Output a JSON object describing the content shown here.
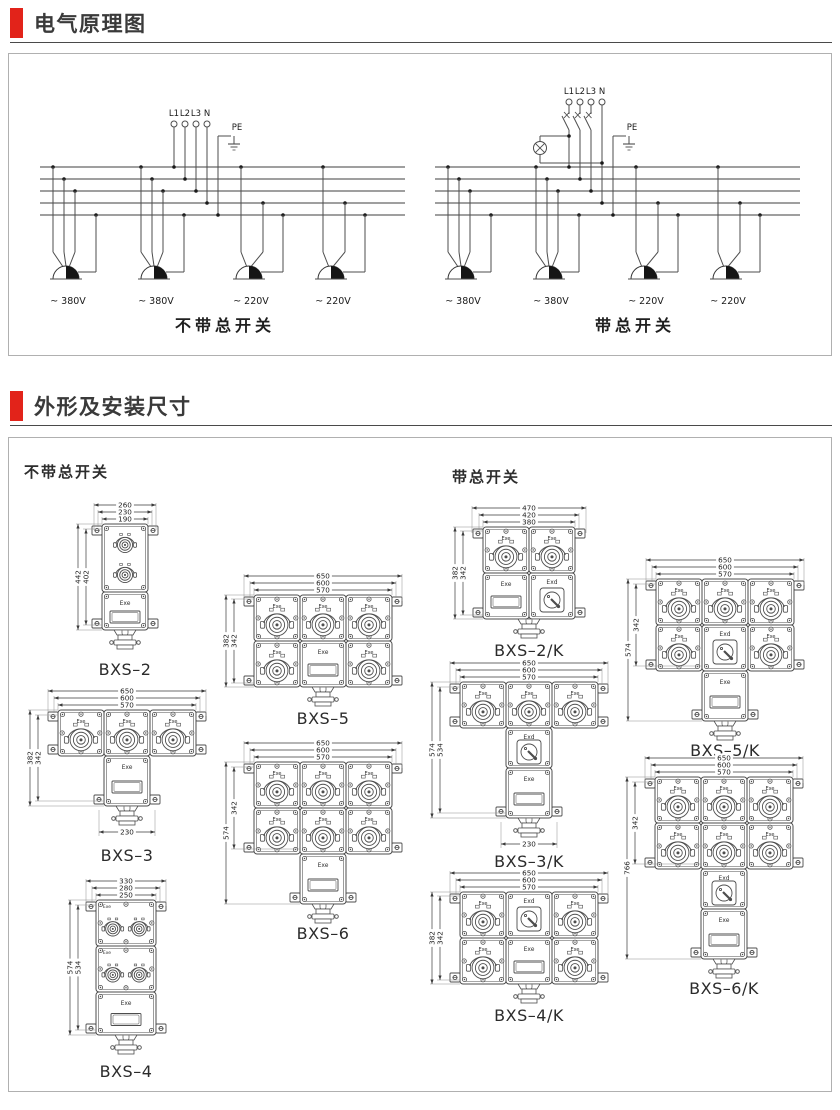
{
  "page": {
    "accent_color": "#e2231a",
    "section1_title": "电气原理图",
    "section2_title": "外形及安装尺寸"
  },
  "schematic": {
    "phase_labels": [
      "L1",
      "L2",
      "L3",
      "N"
    ],
    "pe_label": "PE",
    "diagrams": [
      {
        "caption": "不带总开关",
        "has_main_switch": false,
        "outlets": [
          {
            "voltage": "~ 380V"
          },
          {
            "voltage": "~ 380V"
          },
          {
            "voltage": "~ 220V"
          },
          {
            "voltage": "~ 220V"
          }
        ]
      },
      {
        "caption": "带总开关",
        "has_main_switch": true,
        "outlets": [
          {
            "voltage": "~ 380V"
          },
          {
            "voltage": "~ 380V"
          },
          {
            "voltage": "~ 220V"
          },
          {
            "voltage": "~ 220V"
          }
        ]
      }
    ]
  },
  "dimensions": {
    "left_group_label": "不带总开关",
    "right_group_label": "带总开关",
    "socket_label": "Exe",
    "switch_label": "Exd",
    "window_label": "Exe",
    "products": [
      {
        "id": "bxs2",
        "caption": "BXS–2",
        "top_dims": [
          "260",
          "230",
          "190"
        ],
        "side_dims": [
          "442",
          "402"
        ],
        "bottom_dim": null,
        "layout": "tower2",
        "group": "left"
      },
      {
        "id": "bxs3",
        "caption": "BXS–3",
        "top_dims": [
          "650",
          "600",
          "570"
        ],
        "side_dims": [
          "382",
          "342"
        ],
        "bottom_dim": "230",
        "layout": "t3",
        "group": "left"
      },
      {
        "id": "bxs4",
        "caption": "BXS–4",
        "top_dims": [
          "330",
          "280",
          "250"
        ],
        "side_dims": [
          "574",
          "534"
        ],
        "bottom_dim": null,
        "layout": "tower4",
        "group": "left"
      },
      {
        "id": "bxs5",
        "caption": "BXS–5",
        "top_dims": [
          "650",
          "600",
          "570"
        ],
        "side_dims": [
          "382",
          "342"
        ],
        "bottom_dim": null,
        "layout": "r23",
        "group": "left"
      },
      {
        "id": "bxs6",
        "caption": "BXS–6",
        "top_dims": [
          "650",
          "600",
          "570"
        ],
        "side_dims": [
          "574",
          "342"
        ],
        "bottom_dim": null,
        "layout": "t6",
        "group": "left"
      },
      {
        "id": "bxs2k",
        "caption": "BXS–2/K",
        "top_dims": [
          "470",
          "420",
          "380"
        ],
        "side_dims": [
          "382",
          "342"
        ],
        "bottom_dim": null,
        "layout": "k22",
        "group": "right"
      },
      {
        "id": "bxs3k",
        "caption": "BXS–3/K",
        "top_dims": [
          "650",
          "600",
          "570"
        ],
        "side_dims": [
          "574",
          "534"
        ],
        "bottom_dim": "230",
        "layout": "kt3",
        "group": "right"
      },
      {
        "id": "bxs4k",
        "caption": "BXS–4/K",
        "top_dims": [
          "650",
          "600",
          "570"
        ],
        "side_dims": [
          "382",
          "342"
        ],
        "bottom_dim": null,
        "layout": "k23",
        "group": "right"
      },
      {
        "id": "bxs5k",
        "caption": "BXS–5/K",
        "top_dims": [
          "650",
          "600",
          "570"
        ],
        "side_dims": [
          "574",
          "342"
        ],
        "bottom_dim": null,
        "layout": "k33",
        "group": "right"
      },
      {
        "id": "bxs6k",
        "caption": "BXS–6/K",
        "top_dims": [
          "650",
          "600",
          "570"
        ],
        "side_dims": [
          "766",
          "342"
        ],
        "bottom_dim": null,
        "layout": "kt6",
        "group": "right"
      }
    ]
  }
}
